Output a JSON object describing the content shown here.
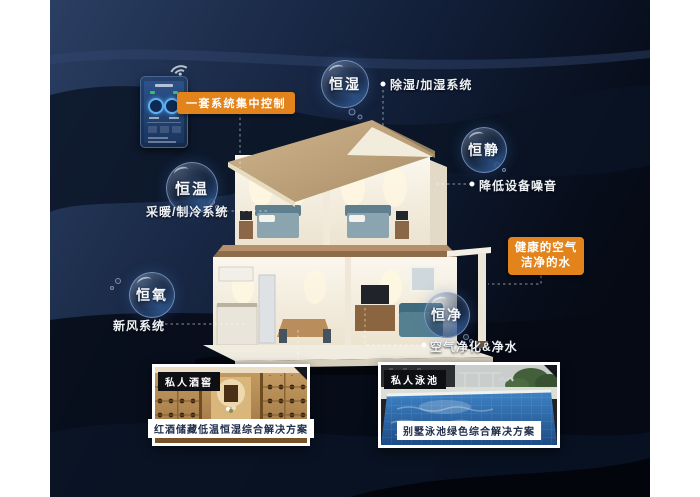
{
  "poster": {
    "control": {
      "label": "一套系统集中控制"
    },
    "bubbles": [
      {
        "label": "恒湿",
        "desc": "除湿/加湿系统"
      },
      {
        "label": "恒静",
        "desc": "降低设备噪音"
      },
      {
        "label": "恒温",
        "desc": "采暖/制冷系统"
      },
      {
        "label": "恒氧",
        "desc": "新风系统"
      },
      {
        "label": "恒净",
        "desc": "空气净化&净水"
      }
    ],
    "highlight": {
      "line1": "健康的空气",
      "line2": "洁净的水"
    },
    "photos": [
      {
        "tag": "私人酒窖",
        "caption": "红酒储藏低温恒湿综合解决方案"
      },
      {
        "tag": "私人泳池",
        "caption": "别墅泳池绿色综合解决方案"
      }
    ],
    "icons": {
      "wifi": "wifi-icon"
    },
    "colors": {
      "accent_orange": "#e2831c",
      "background_navy": "#16243e",
      "bubble_rim": "#9ab4d8",
      "connector_line": "#ffffff",
      "photo_tag_bg": "#0d0f12",
      "caption_text": "#1e2d4a"
    }
  }
}
